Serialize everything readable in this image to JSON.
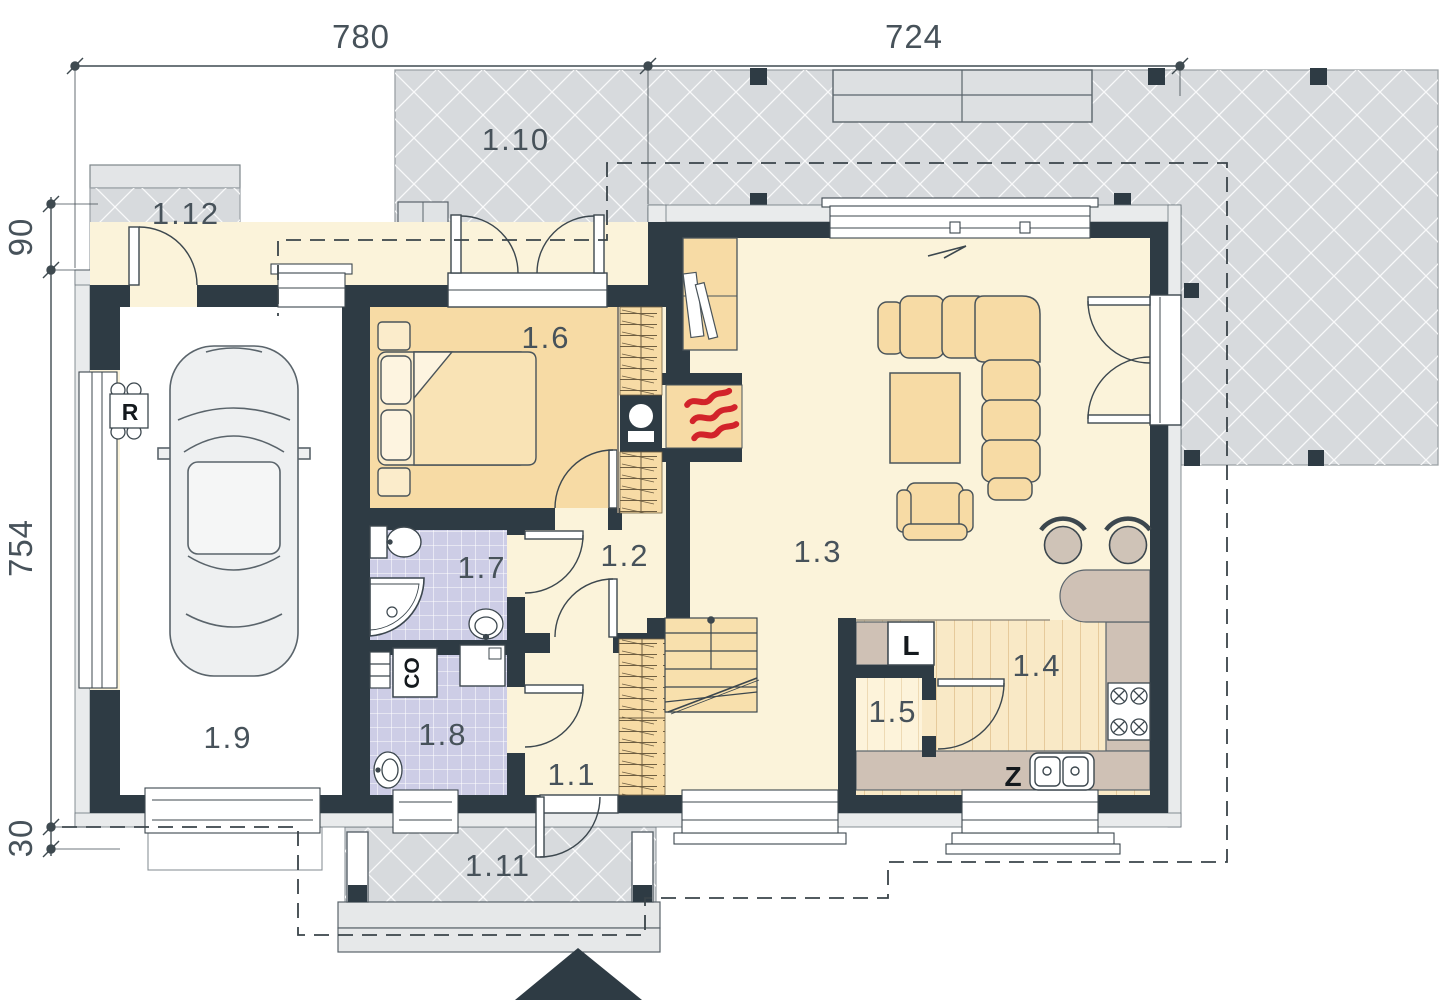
{
  "plan": {
    "title": "Ground floor plan",
    "dimensions": {
      "width_left": "780",
      "width_right": "724",
      "offset_top": "90",
      "height_total": "754",
      "offset_bottom": "30"
    },
    "rooms": {
      "hall": "1.1",
      "corridor": "1.2",
      "living_room": "1.3",
      "kitchen": "1.4",
      "pantry": "1.5",
      "bedroom": "1.6",
      "bathroom": "1.7",
      "utility": "1.8",
      "garage": "1.9",
      "terrace_main": "1.10",
      "entrance_porch": "1.11",
      "terrace_side": "1.12"
    },
    "equipment": {
      "workbench": "R",
      "boiler": "CO",
      "fridge": "L",
      "sink_unit": "Z"
    },
    "colors": {
      "wall": "#2e3b44",
      "floor_cream": "#fbf3da",
      "floor_bedroom": "#f7dba5",
      "floor_tile": "#cdcde6",
      "terrace": "#d7dadd",
      "counter": "#cfc1b5",
      "flame": "#d2232a"
    }
  }
}
